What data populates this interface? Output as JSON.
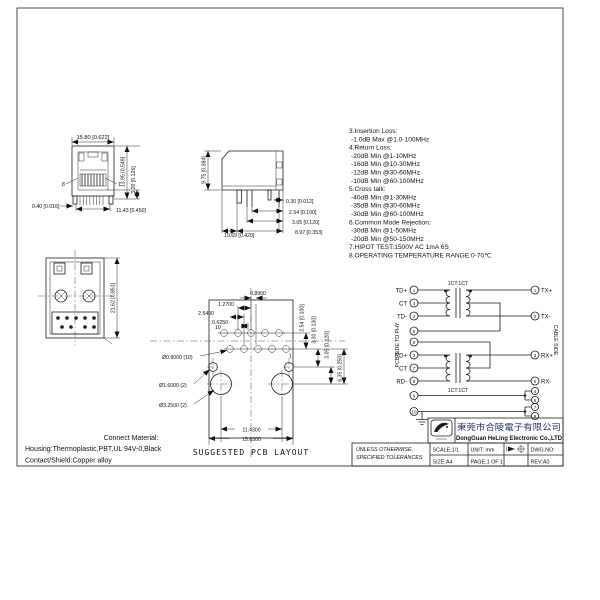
{
  "notes": {
    "lines": [
      "3.Insertion Loss:",
      " -1.0dB Max @1.0-100MHz",
      "4.Return Loss:",
      " -20dB Min @1-10MHz",
      " -16dB Min @10-30MHz",
      " -12dB Min @30-60MHz",
      " -10dB Min @60-100MHz",
      "5.Cross talk:",
      " -40dB Min @1-30MHz",
      " -35dB Min @30-60MHz",
      " -30dB Min @60-100MHz",
      "6.Common Mode Rejection:",
      " -30dB Min @1-50MHz",
      " -20dB Min @50-150MHz",
      "7.HIPOT TEST:1500V AC 1mA 6S",
      "8.OPERATING TEMPERATURE RANGE:0-70℃"
    ]
  },
  "front_view": {
    "dim_width": "15.80 [0.622]",
    "dim_height": "13.95 [0.549]",
    "dim_tail": "3.20 [0.126]",
    "dim_pin": "0.40 [0.016]",
    "dim_span": "11.43 [0.450]",
    "pin_left": "8",
    "pin_right": "1"
  },
  "side_view": {
    "dim_height": "9.75 [0.384]",
    "dim_1": "0.30 [0.012]",
    "dim_2": "2.54 [0.100]",
    "dim_3": "3.05 [0.120]",
    "dim_4": "8.97 [0.353]",
    "dim_5": "10.69 [0.420]"
  },
  "bottom_view": {
    "dim_depth": "21.62 [0.851]"
  },
  "pcb_layout": {
    "caption": "SUGGESTED PCB LAYOUT",
    "dim_top_1": "0.8900",
    "dim_top_2": "1.2700",
    "dim_top_3": "2.5400",
    "dim_top_4": "0.6250",
    "dim_right_1": "2.54 [0.100]",
    "dim_right_2": "3.30 [0.130]",
    "dim_right_3": "3.05 [0.120]",
    "dim_right_4": "6.35 [0.250]",
    "dim_bottom_1": "11.4300",
    "dim_bottom_2": "15.6300",
    "hole_small": "Ø0.9000 (10)",
    "hole_mid": "Ø1.6000 (2)",
    "hole_big": "Ø3.2500 (2)",
    "pin_first": "10",
    "pin_last": "1"
  },
  "schematic": {
    "ratio_top": "1CT:1CT",
    "ratio_bottom": "1CT:1CT",
    "left_label": "PCB SIDE TO PHY",
    "right_label": "CABLE SIDE",
    "pcb_pins": [
      {
        "n": "1",
        "label": "TD+"
      },
      {
        "n": "4",
        "label": "CT"
      },
      {
        "n": "2",
        "label": "TD-"
      },
      {
        "n": "5",
        "label": ""
      },
      {
        "n": "8",
        "label": ""
      },
      {
        "n": "3",
        "label": "RD+"
      },
      {
        "n": "7",
        "label": "CT"
      },
      {
        "n": "6",
        "label": "RD-"
      },
      {
        "n": "9",
        "label": ""
      },
      {
        "n": "10",
        "label": ""
      }
    ],
    "cable_pins": [
      {
        "n": "1",
        "label": "TX+"
      },
      {
        "n": "2",
        "label": "TX-"
      },
      {
        "n": "3",
        "label": "RX+"
      },
      {
        "n": "6",
        "label": "RX-"
      },
      {
        "n": "4",
        "label": ""
      },
      {
        "n": "5",
        "label": ""
      },
      {
        "n": "7",
        "label": ""
      },
      {
        "n": "8",
        "label": ""
      }
    ]
  },
  "materials": {
    "title": "Connect Material:",
    "line_1": "Housing:Thermoplastic,PBT,UL 94V-0,Black",
    "line_2": "Contact/Shield:Copper alloy"
  },
  "title_block": {
    "company_cn": "東莞市合陵電子有限公司",
    "company_en": "DongGuan HeLing Electronic Co.,LTD",
    "tolerance_1": "UNLESS OTHERWISE",
    "tolerance_2": "SPECIFIED TOLERANCES",
    "scale": "SCALE:1/1",
    "unit": "UNIT: mm",
    "dwg_no": "DWG.NO:",
    "size": "SIZE:A4",
    "page": "PAGE:1 OF 1",
    "rev": "REV:A0"
  }
}
